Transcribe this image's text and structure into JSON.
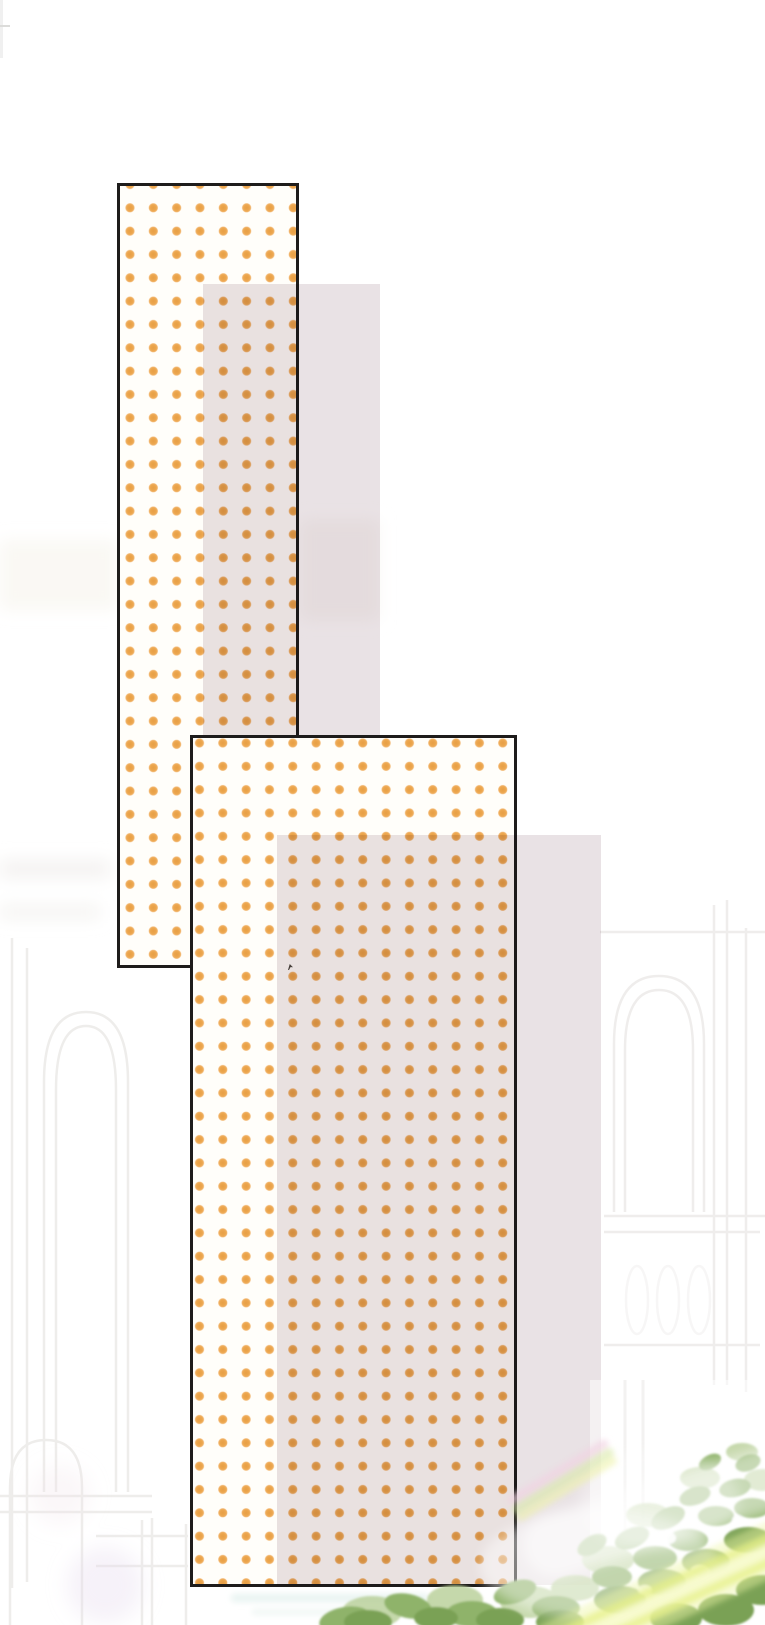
{
  "page": {
    "kind": "webtoon-scene-background",
    "visible_text": "",
    "elements": [
      "dotted-screentone-panel-1",
      "dotted-screentone-panel-2",
      "lavender-overlay-1",
      "lavender-overlay-2",
      "palace-lineart-background",
      "foliage-cluster",
      "light-beam",
      "prism-flare",
      "ink-speck"
    ]
  },
  "colors": {
    "canvas": "#ffffff",
    "panel_fill": "#fffefa",
    "panel_border": "#1e1c1b",
    "dot_orange": "#eca64d",
    "lavender": "#e9e2e5",
    "leaf_dark": "#7aa155",
    "leaf_mid": "#8fb36b",
    "leaf_light": "#b7cf97",
    "beam_core": "#eef391",
    "prism_pink": "#f2d3e2",
    "prism_green": "#d9eaa8",
    "aqua_band": "#e3f1ee",
    "lilac_glow": "#e4d9ee",
    "lineart": "#edebe9"
  }
}
